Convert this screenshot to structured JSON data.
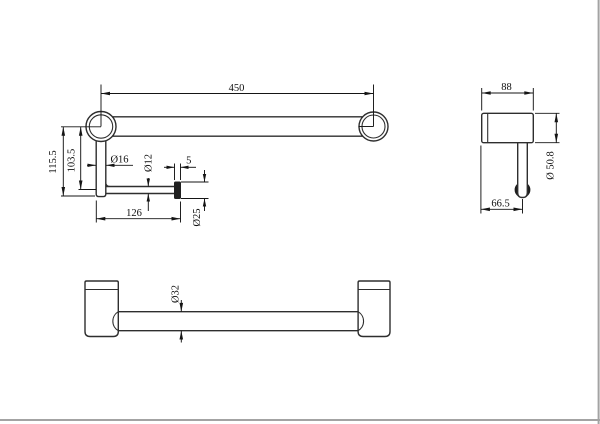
{
  "colors": {
    "line": "#2e2e2e",
    "dimension": "#151515",
    "solid_fill": "#1f1f1f",
    "background": "#ffffff",
    "window_edge": "#a3a3a3"
  },
  "front_view": {
    "length": "450",
    "overall_drop": "115.5",
    "drop_to_rod_center": "103.5",
    "post_diameter": "Ø16",
    "rod_diameter": "Ø12",
    "cap_thickness": "5",
    "rod_length": "126",
    "cap_diameter": "Ø25"
  },
  "side_view": {
    "depth": "88",
    "flange_diameter": "Ø 50.8",
    "rod_offset_from_wall": "66.5"
  },
  "plan_view": {
    "bar_diameter": "Ø32"
  }
}
